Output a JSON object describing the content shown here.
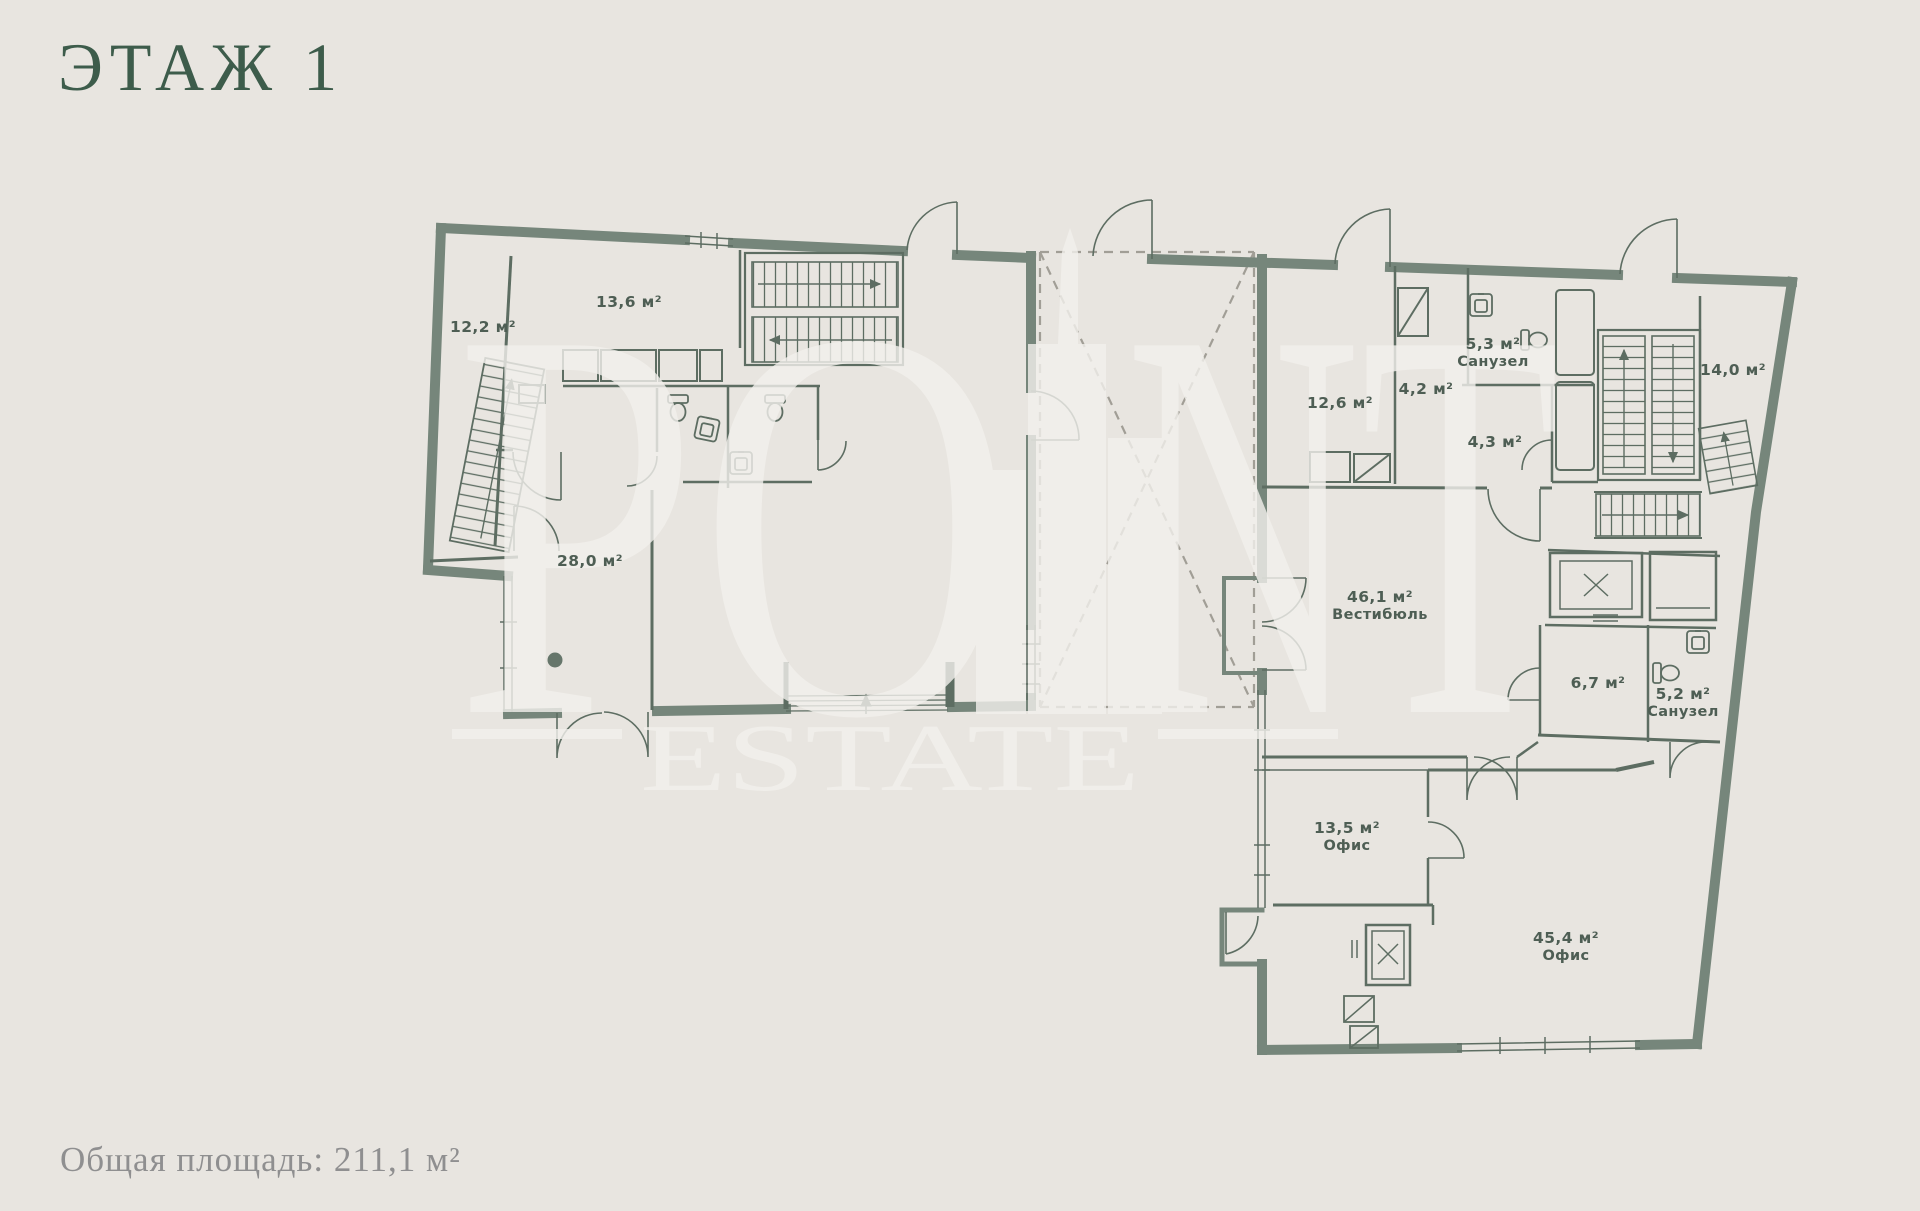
{
  "title": "ЭТАЖ 1",
  "footer": {
    "text": "Общая площадь: 211,1 м²"
  },
  "watermark": {
    "word_part1": "PO",
    "word_part2": "NT",
    "word2": "ESTATE"
  },
  "floor_plan": {
    "total_area_m2": "211,1",
    "rooms": [
      {
        "id": "room-12-2",
        "area": "12,2 м²",
        "name": "",
        "x": 483,
        "y": 332
      },
      {
        "id": "room-13-6",
        "area": "13,6 м²",
        "name": "",
        "x": 629,
        "y": 307
      },
      {
        "id": "room-28-0",
        "area": "28,0 м²",
        "name": "",
        "x": 590,
        "y": 566
      },
      {
        "id": "room-12-6",
        "area": "12,6 м²",
        "name": "",
        "x": 1340,
        "y": 408
      },
      {
        "id": "room-4-2",
        "area": "4,2 м²",
        "name": "",
        "x": 1426,
        "y": 394
      },
      {
        "id": "room-5-3",
        "area": "5,3 м²",
        "name": "Санузел",
        "x": 1493,
        "y": 349
      },
      {
        "id": "room-4-3",
        "area": "4,3 м²",
        "name": "",
        "x": 1495,
        "y": 447
      },
      {
        "id": "room-14-0",
        "area": "14,0 м²",
        "name": "",
        "x": 1733,
        "y": 375
      },
      {
        "id": "room-46-1",
        "area": "46,1 м²",
        "name": "Вестибюль",
        "x": 1380,
        "y": 602
      },
      {
        "id": "room-6-7",
        "area": "6,7 м²",
        "name": "",
        "x": 1598,
        "y": 688
      },
      {
        "id": "room-5-2",
        "area": "5,2 м²",
        "name": "Санузел",
        "x": 1683,
        "y": 699
      },
      {
        "id": "room-13-5",
        "area": "13,5 м²",
        "name": "Офис",
        "x": 1347,
        "y": 833
      },
      {
        "id": "room-45-4",
        "area": "45,4 м²",
        "name": "Офис",
        "x": 1566,
        "y": 943
      }
    ]
  },
  "colors": {
    "background": "#e8e5e0",
    "wall": "#76867b",
    "line": "#5d6d62",
    "dashed": "#a19e96",
    "title_text": "#3d5c4b",
    "label_text": "#4e5e54",
    "footer_text": "#8f8f90",
    "watermark": "#f3f1ed"
  }
}
